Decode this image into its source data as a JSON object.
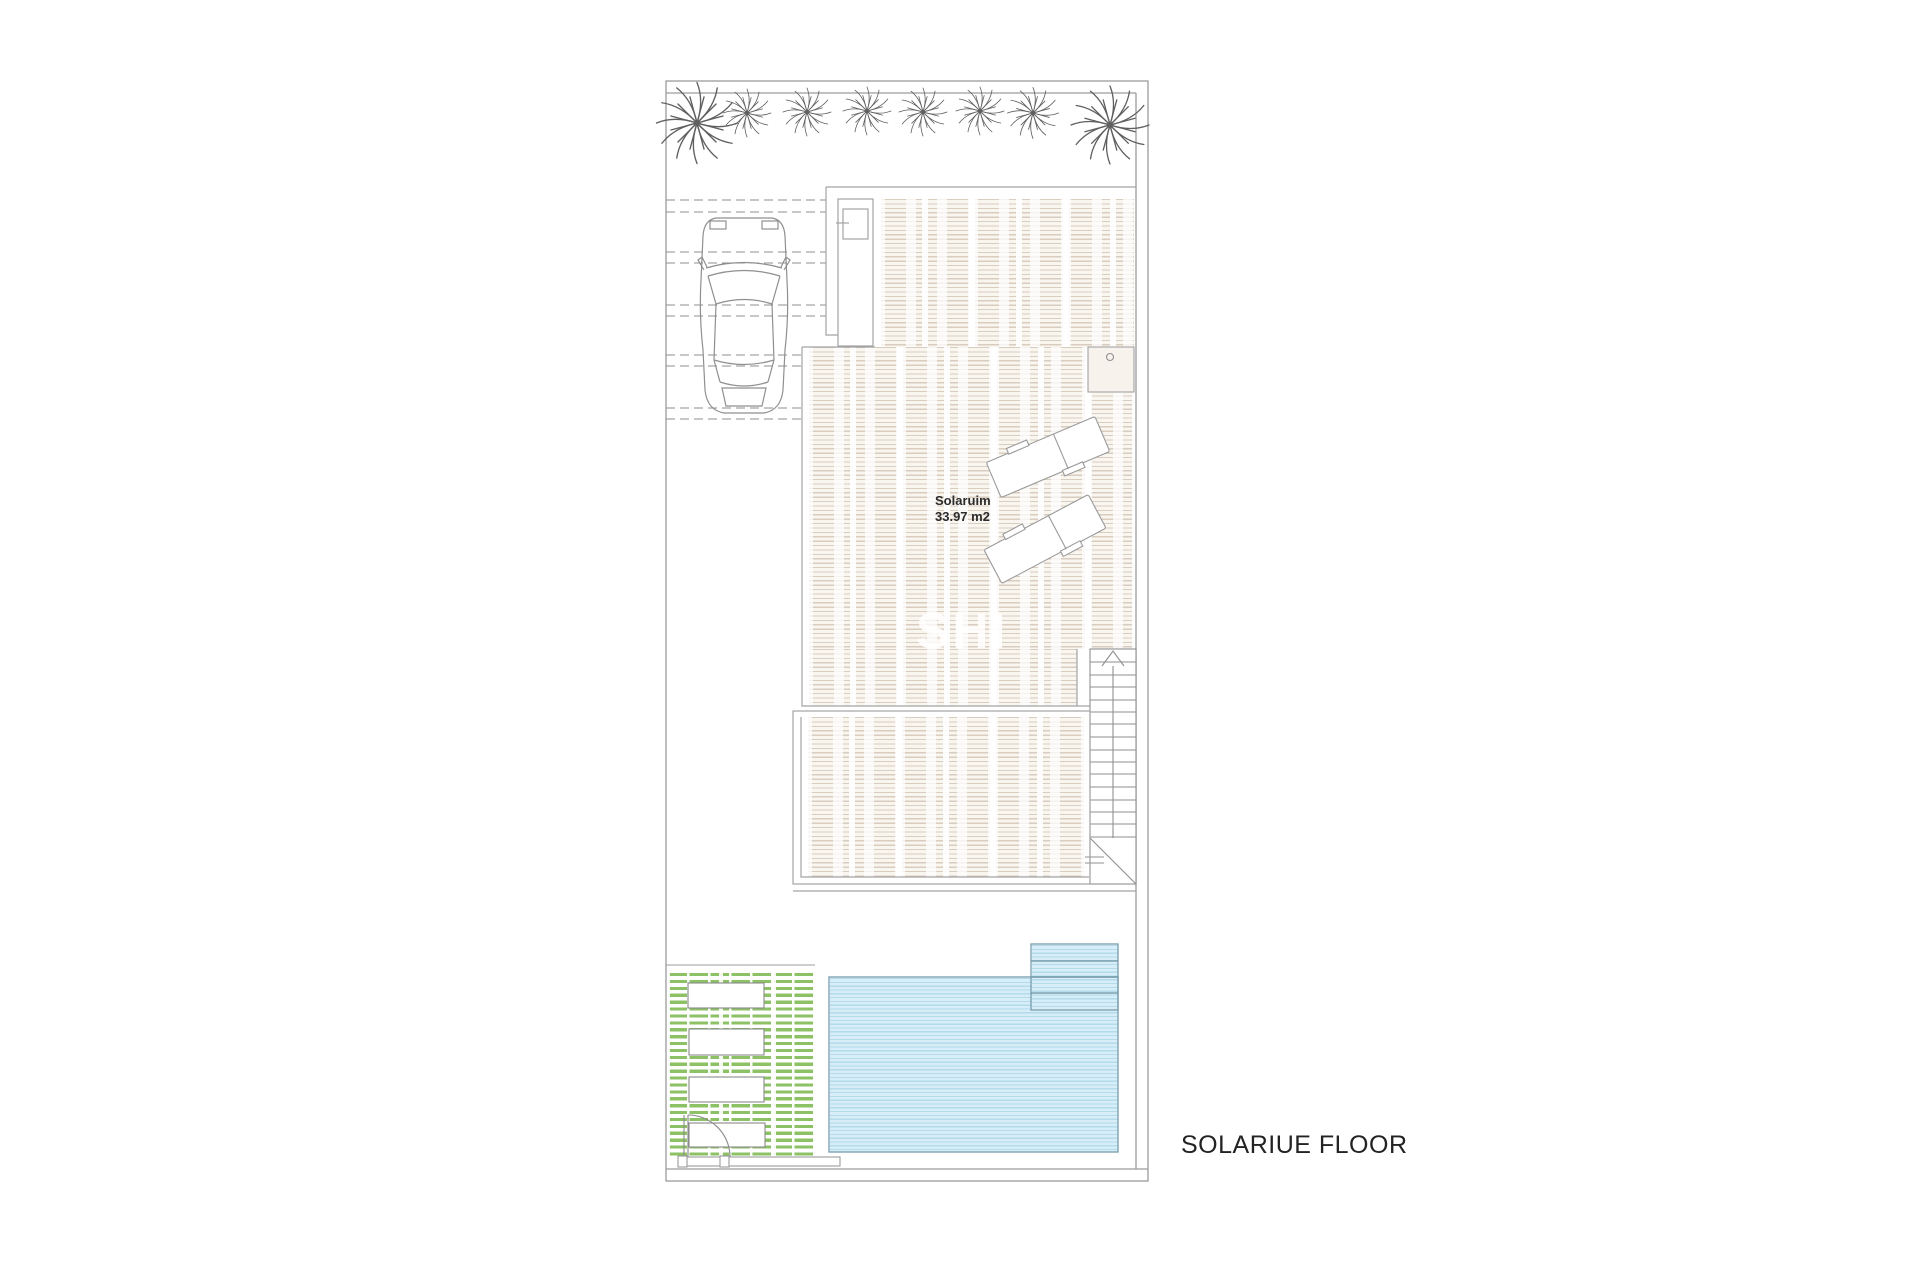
{
  "sheet": {
    "background": "#ffffff"
  },
  "plan": {
    "floor_title": "SOLARIUE FLOOR",
    "room": {
      "name": "Solaruim",
      "area": "33.97 m2"
    },
    "watermark": "SHI",
    "colors": {
      "outline_gray": "#9c9c9c",
      "building_line": "#a3a3a3",
      "deck_stripe": "#d9cdc0",
      "deck_base": "#f9f5ef",
      "pool_fill": "#d7edf8",
      "pool_stripe": "#b3dbec",
      "pool_border": "#7fa3b2",
      "grass_green": "#8cc166",
      "label_text": "#2b2b2b"
    },
    "features": {
      "palm_trees": 8,
      "sun_loungers": 2,
      "planters": 4,
      "pool_steps": 4,
      "stair_treads": 15,
      "parking_line_pairs": 5
    }
  }
}
